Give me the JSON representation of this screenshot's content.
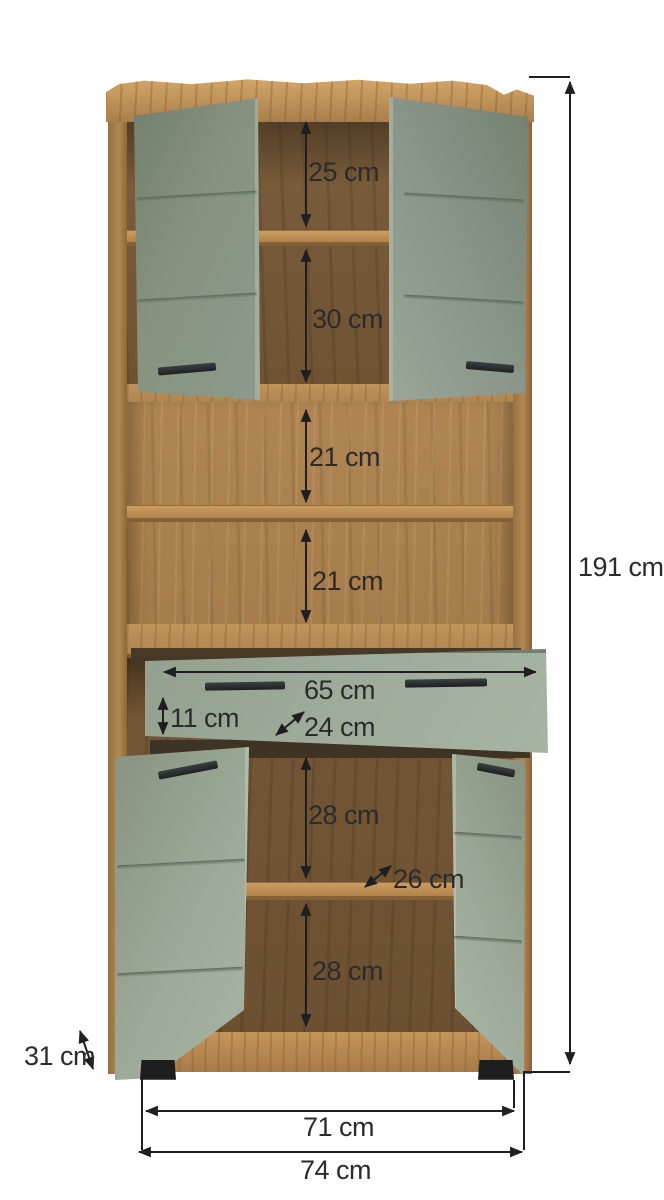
{
  "diagram": {
    "description": "Dimension diagram of a tall cabinet with two upper doors, two open shelves, one pull-out drawer and two lower doors",
    "unit": "cm"
  },
  "measurements": {
    "upper_compartment": "25 cm",
    "upper_compartment_2": "30 cm",
    "open_compartment_1": "21 cm",
    "open_compartment_2": "21 cm",
    "drawer_width": "65 cm",
    "drawer_height": "11 cm",
    "drawer_depth": "24 cm",
    "lower_compartment_1": "28 cm",
    "lower_shelf_depth": "26 cm",
    "lower_compartment_2": "28 cm",
    "total_height": "191 cm",
    "base_depth": "31 cm",
    "feet_span": "71 cm",
    "total_width": "74 cm"
  },
  "colors": {
    "background": "#ffffff",
    "label_text": "#2b2b2b",
    "dimension_line": "#1f1f1f",
    "wood_top_panel": "#c2955d",
    "wood_frame": "#a87c4a",
    "wood_interior_dark": "#6f5433",
    "wood_interior_light": "#ab8150",
    "door_green_dark": "#87937f",
    "door_green_light": "#a7b3a1",
    "handle_black": "#242628",
    "feet_black": "#1e1e1e"
  }
}
